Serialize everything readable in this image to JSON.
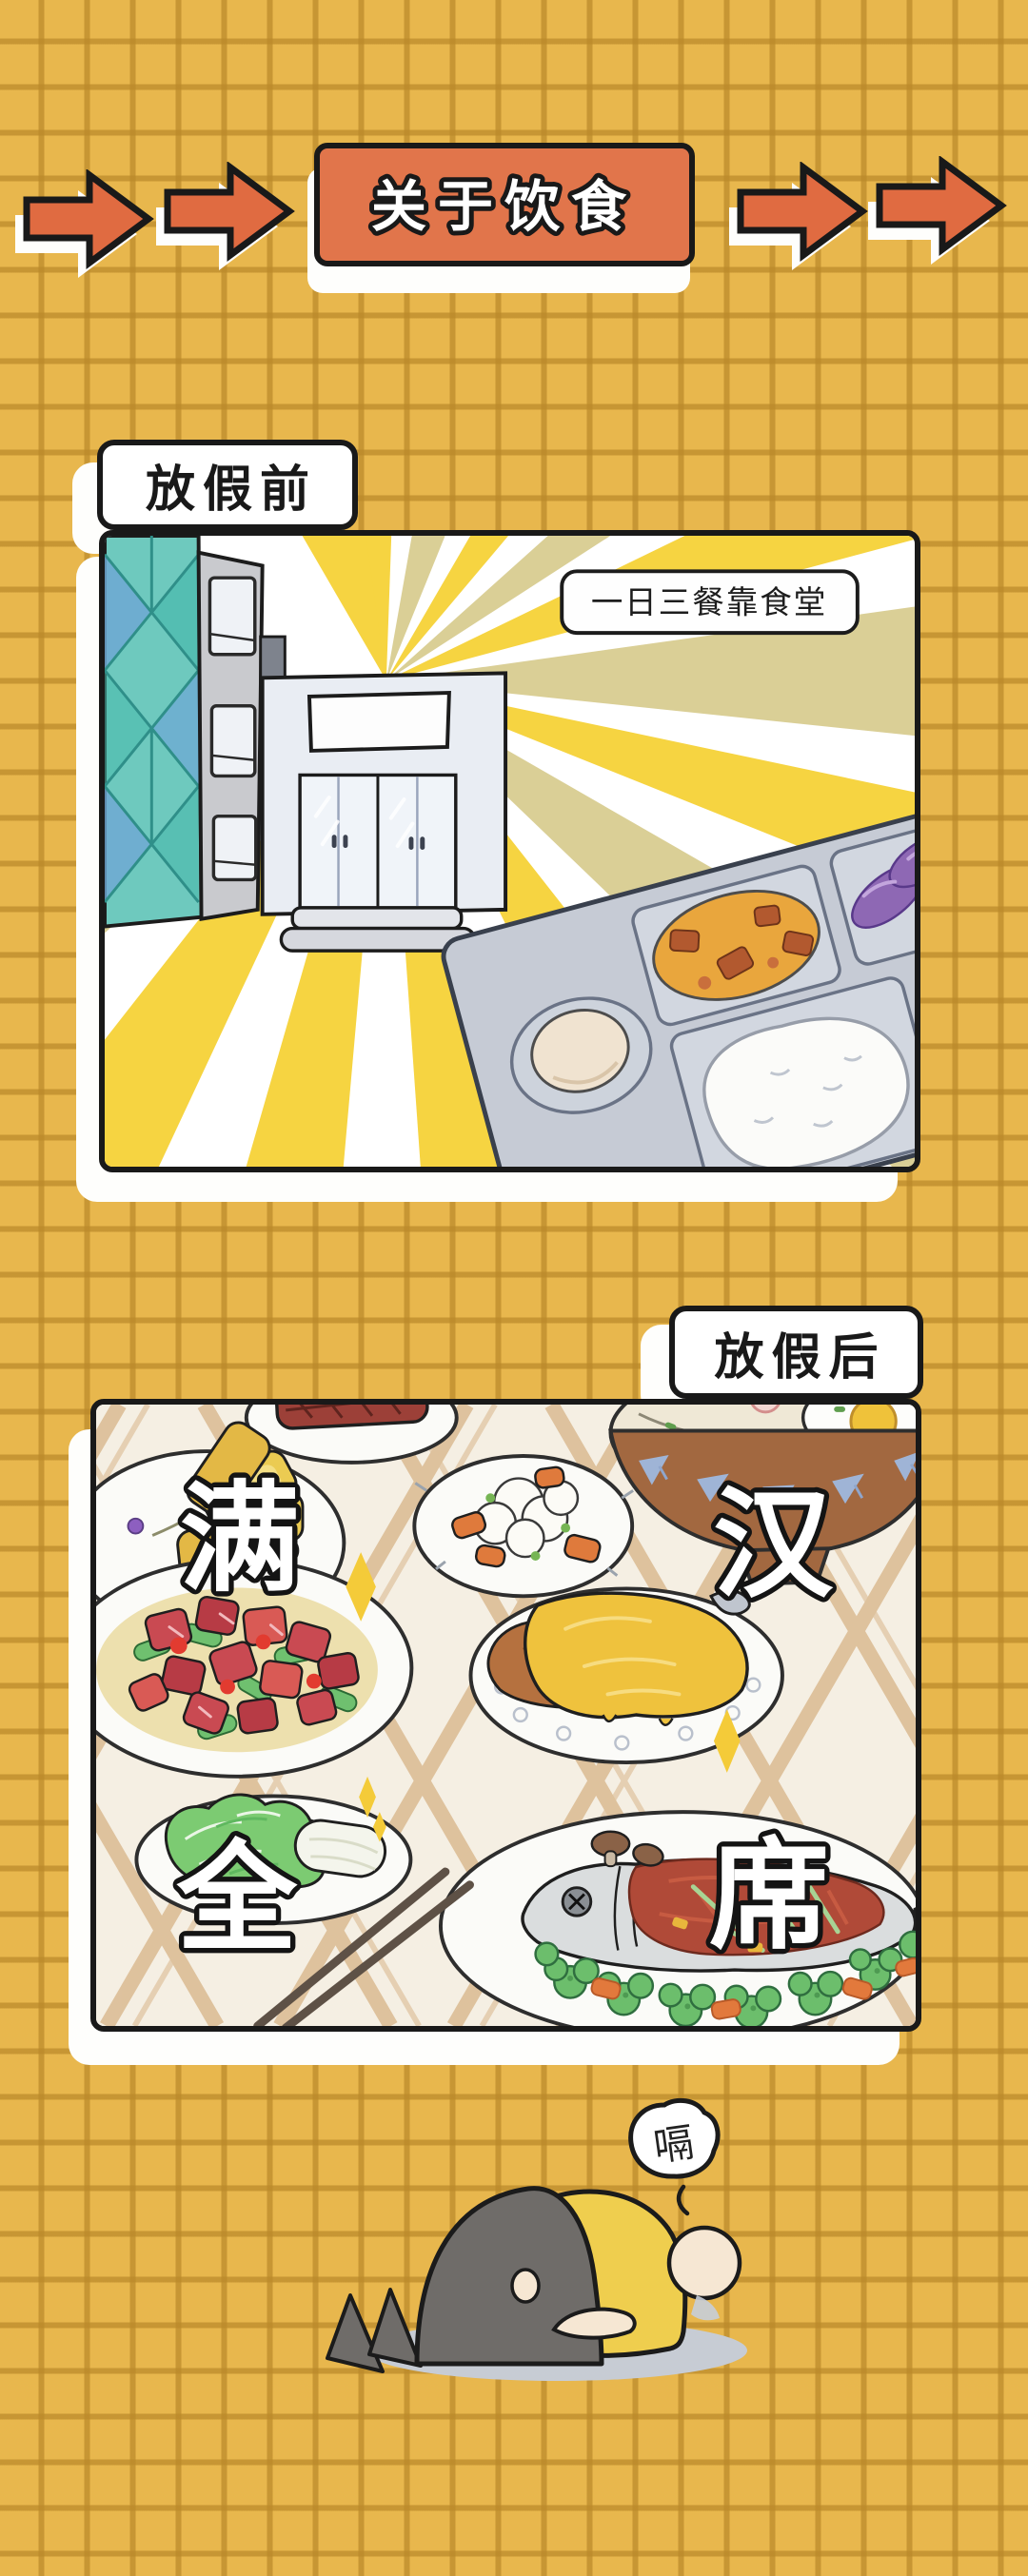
{
  "page": {
    "type": "comic-page",
    "background_color": "#E8B74D",
    "grid_line_color": "#BA892A",
    "outline_color": "#191919",
    "panel_background": "#FFFFFF"
  },
  "header": {
    "title": "关于饮食",
    "banner_color": "#E1754B",
    "arrow_color": "#E06B41",
    "left_arrow_count": 2,
    "right_arrow_count": 2
  },
  "panel_before": {
    "label": "放假前",
    "caption": "一日三餐靠食堂",
    "scene": {
      "name": "canteen-entrance-with-sunburst",
      "ray_colors": [
        "#F6D441",
        "#DACF96"
      ],
      "elements": [
        "glass-curtain-wall-building",
        "office-building-with-windows",
        "canteen-double-doors",
        "blank-canteen-sign",
        "canteen-meal-tray"
      ],
      "tray_items": [
        "boiled-egg",
        "curry-with-meat-chunks",
        "braised-eggplant",
        "green-bean-and-carrot-stir-fry",
        "white-rice"
      ]
    }
  },
  "panel_after": {
    "label": "放假后",
    "feast_phrase": "满汉全席",
    "feast_chars": [
      "满",
      "汉",
      "全",
      "席"
    ],
    "tablecloth": "cream-plaid",
    "dishes": [
      "sliced-egg-omelet-roll",
      "grilled-steak",
      "cauliflower-stir-fry",
      "noodle-soup-with-fried-egg",
      "stir-fried-diced-beef-with-peppers",
      "golden-sauce-roast-chicken",
      "napa-cabbage",
      "whole-fish-with-broccoli-and-chili"
    ],
    "extras": [
      "chopsticks",
      "yellow-sparkles"
    ]
  },
  "outro": {
    "burp": "嗝",
    "character": "person-lying-face-down-after-overeating"
  }
}
